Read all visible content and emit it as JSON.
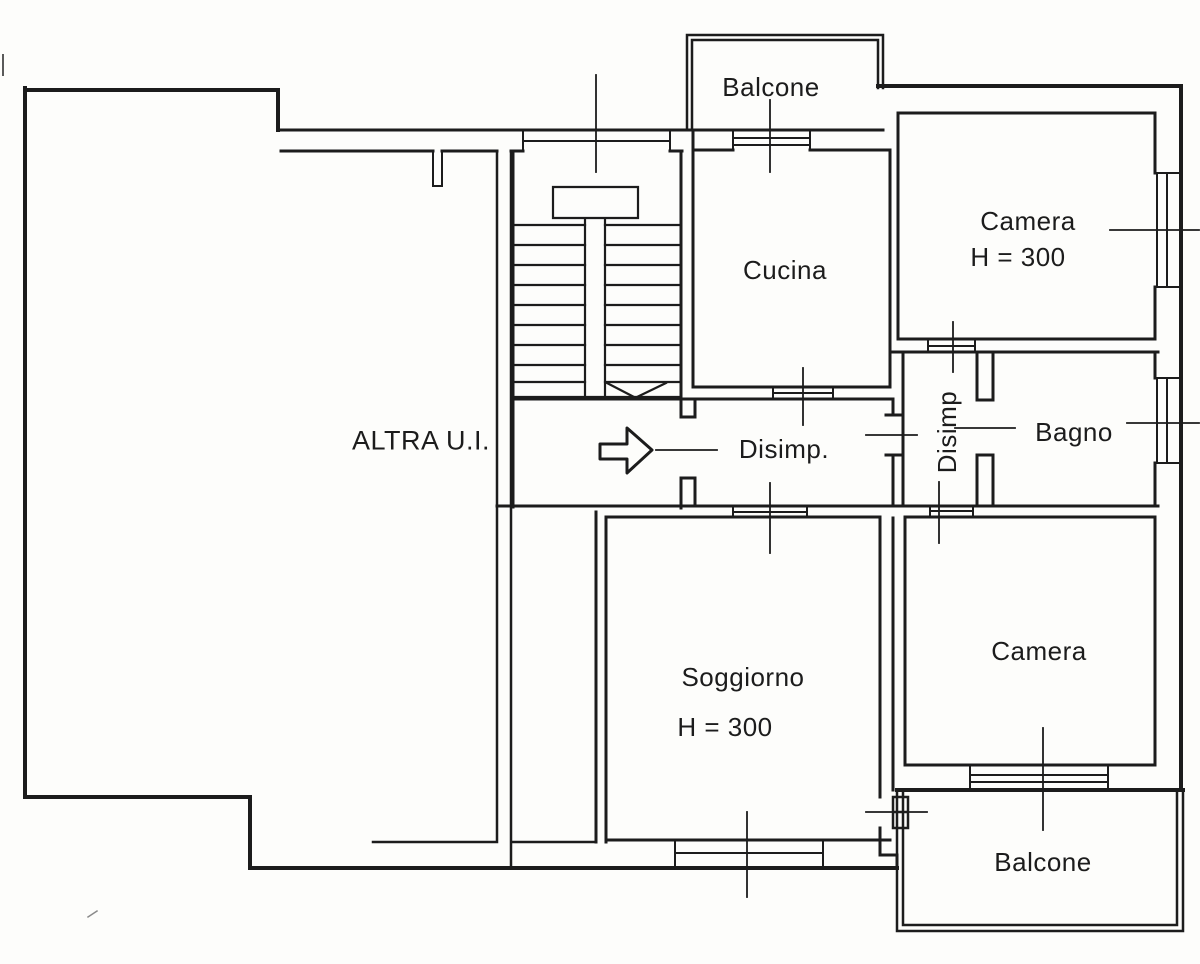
{
  "plan": {
    "rooms": [
      {
        "id": "balcone-top",
        "label": "Balcone"
      },
      {
        "id": "cucina",
        "label": "Cucina"
      },
      {
        "id": "camera-1",
        "label": "Camera",
        "height_label": "H = 300"
      },
      {
        "id": "altra-ui",
        "label": "ALTRA U.I."
      },
      {
        "id": "disimp-main",
        "label": "Disimp."
      },
      {
        "id": "disimp-small",
        "label": "Disimp"
      },
      {
        "id": "bagno",
        "label": "Bagno"
      },
      {
        "id": "soggiorno",
        "label": "Soggiorno",
        "height_label": "H = 300"
      },
      {
        "id": "camera-2",
        "label": "Camera"
      },
      {
        "id": "balcone-bottom",
        "label": "Balcone"
      }
    ],
    "colors": {
      "ink": "#1c1c1c",
      "paper": "#fdfdfb"
    }
  }
}
